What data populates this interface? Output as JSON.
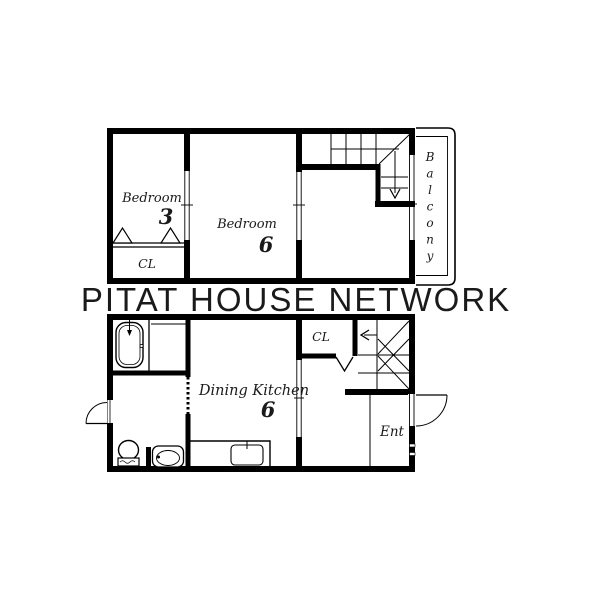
{
  "watermark": "PITAT HOUSE NETWORK",
  "colors": {
    "wall": "#000000",
    "background": "#ffffff",
    "watermark": "#d9d9d9"
  },
  "upper_floor": {
    "bedroom_left": {
      "name": "Bedroom",
      "size": "3"
    },
    "bedroom_center": {
      "name": "Bedroom",
      "size": "6"
    },
    "closet_label": "CL",
    "balcony_label": "Balcony"
  },
  "lower_floor": {
    "dining_kitchen": {
      "name": "Dining Kitchen",
      "size": "6"
    },
    "closet_label": "CL",
    "entrance_label": "Ent"
  }
}
